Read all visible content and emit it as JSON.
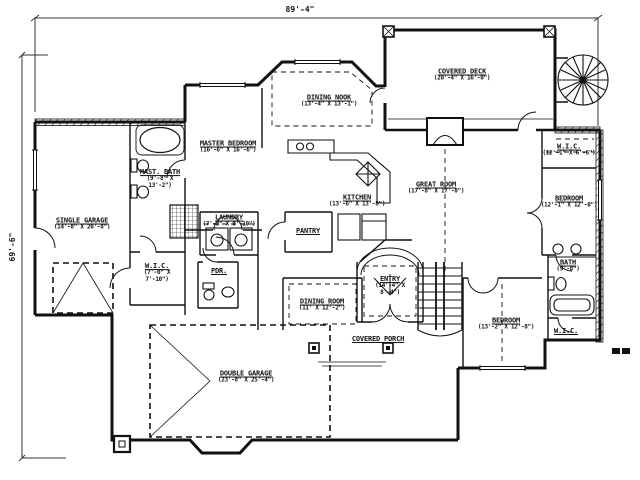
{
  "sheet": {
    "background": "#ffffff",
    "ink": "#1a1a1a"
  },
  "dimensions": {
    "width_label": "89'-4\"",
    "height_label": "69'-6\""
  },
  "rooms": {
    "single_garage": {
      "name": "SINGLE GARAGE",
      "dims": "(14'-8\" X 20'-8\")"
    },
    "master_bath": {
      "name": "MAST. BATH",
      "dims": "(9'-8\" X 13'-2\")"
    },
    "wic_master": {
      "name": "W.I.C.",
      "dims": "(7'-0\" X 7'-10\")"
    },
    "laundry": {
      "name": "LAUNDRY",
      "dims": "(7'-3\" X 8'-10\")"
    },
    "powder": {
      "name": "PDR."
    },
    "master_bedroom": {
      "name": "MASTER BEDROOM",
      "dims": "(16'-6\" X 16'-6\")"
    },
    "dining_nook": {
      "name": "DINING NOOK",
      "dims": "(13'-4\" X 13'-1\")"
    },
    "pantry": {
      "name": "PANTRY"
    },
    "kitchen": {
      "name": "KITCHEN",
      "dims": "(13'-6\" X 13'-8\")"
    },
    "covered_deck": {
      "name": "COVERED DECK",
      "dims": "(20'-4\" X 16'-0\")"
    },
    "great_room": {
      "name": "GREAT ROOM",
      "dims": "(17'-8\" X 17'-8\")"
    },
    "wic_right": {
      "name": "W.I.C.",
      "dims": "(12'-1\" X 6'-6\")"
    },
    "bedroom_right": {
      "name": "BEDROOM",
      "dims": "(12'-1\" X 12'-0\")"
    },
    "bath_right": {
      "name": "BATH",
      "dims": "(9'-8\")"
    },
    "wic_lower": {
      "name": "W.I.C."
    },
    "entry": {
      "name": "ENTRY",
      "dims": "(14'-4\" X 8'-4\")"
    },
    "dining_room": {
      "name": "DINING ROOM",
      "dims": "(11' X 12'-2\")"
    },
    "covered_porch": {
      "name": "COVERED PORCH"
    },
    "bedroom_lower": {
      "name": "BEDROOM",
      "dims": "(13'-2\" X 12'-8\")"
    },
    "double_garage": {
      "name": "DOUBLE GARAGE",
      "dims": "(23'-8\" X 25'-4\")"
    }
  }
}
